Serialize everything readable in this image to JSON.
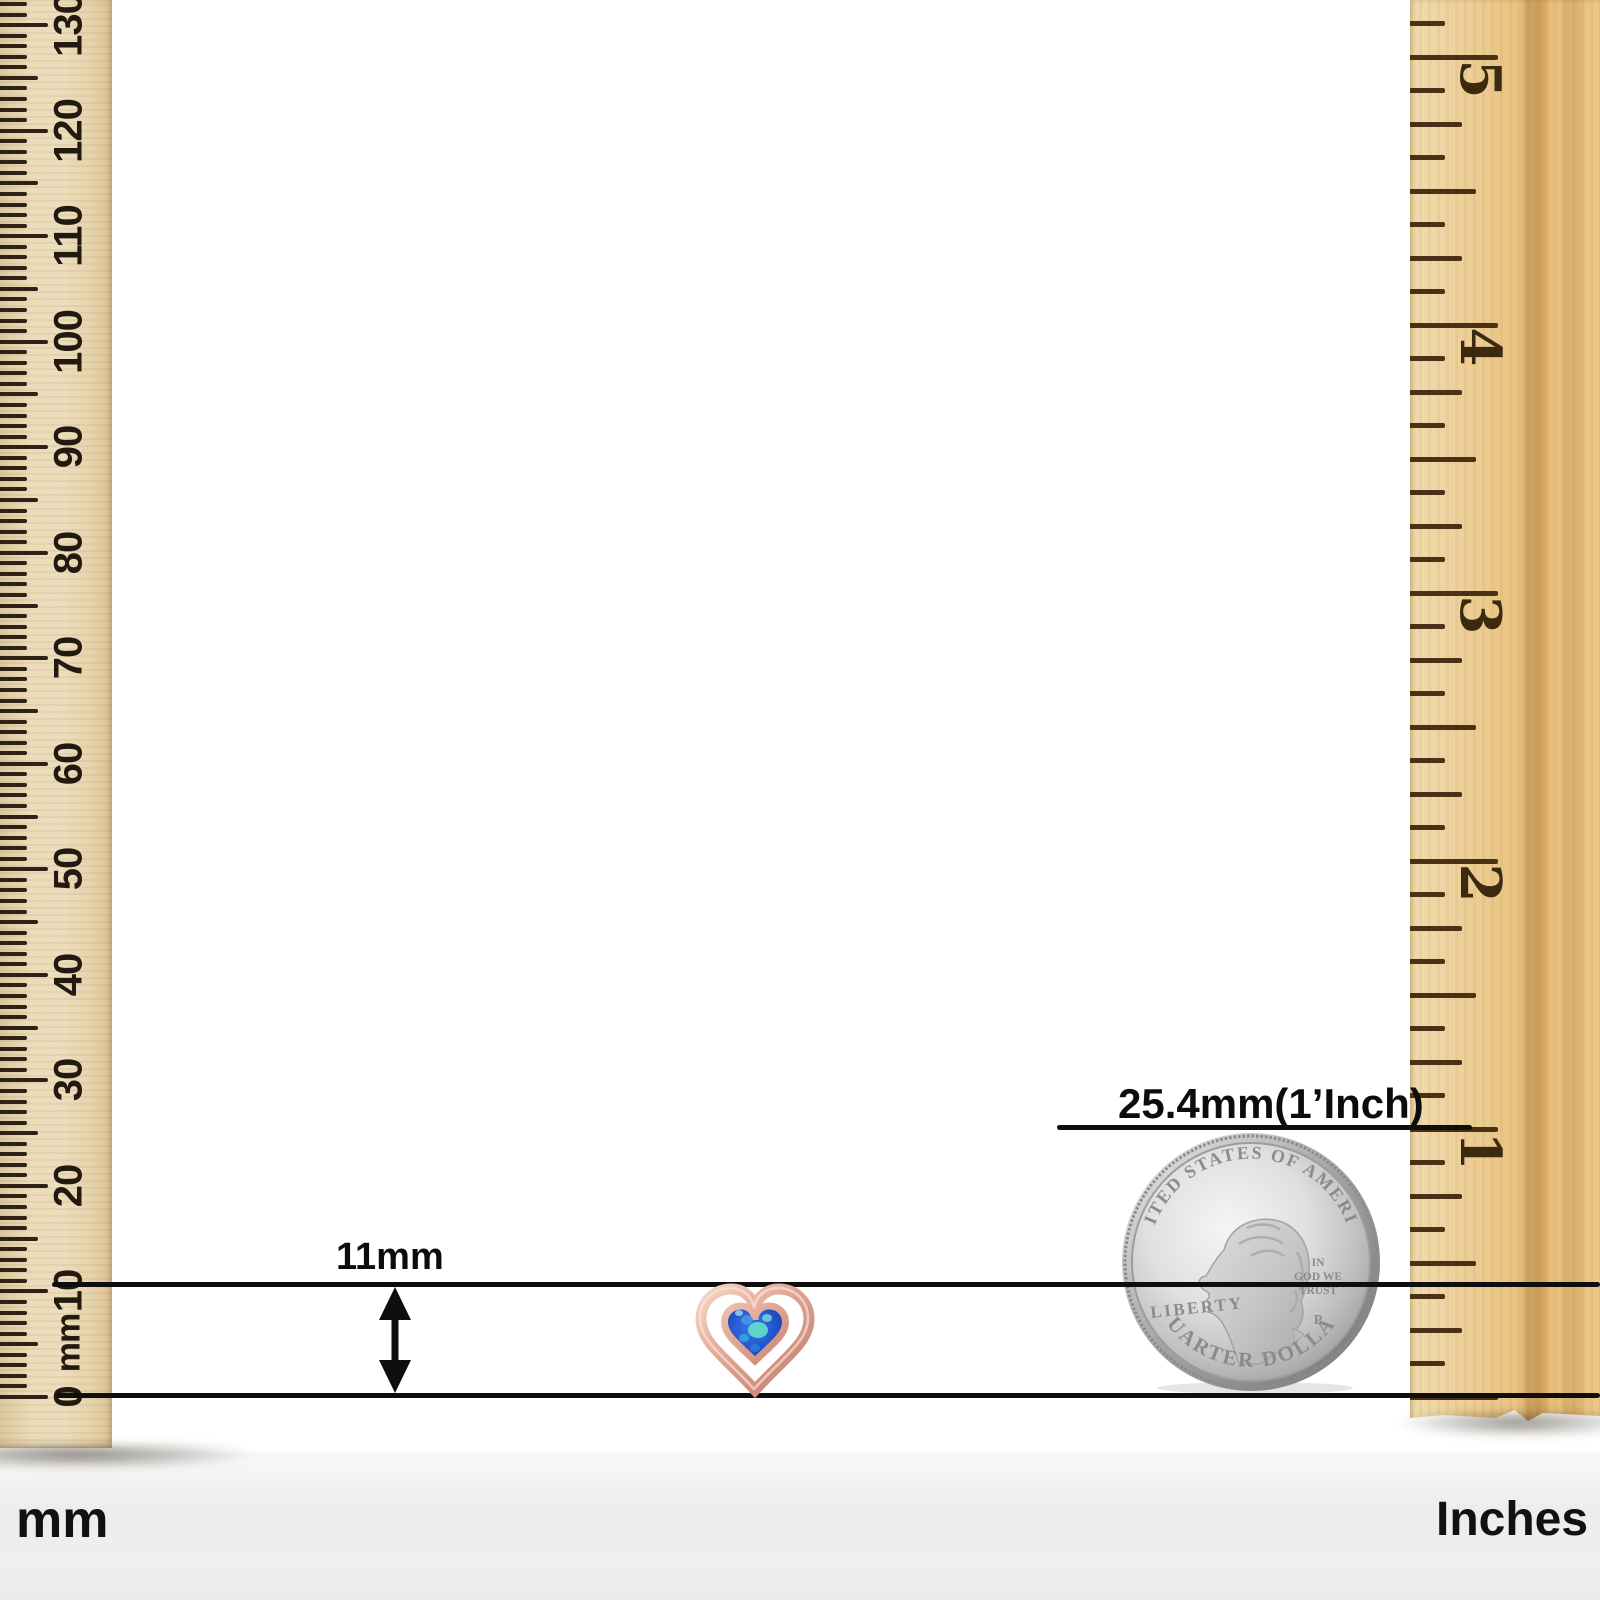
{
  "measurement": {
    "item_height_label": "11mm",
    "coin_reference_label": "25.4mm(1’Inch)"
  },
  "footer": {
    "left_unit": "mm",
    "right_unit": "Inches"
  },
  "left_ruler": {
    "zero_label": "0",
    "unit_label": "mm",
    "tick_labels": [
      "10",
      "20",
      "30",
      "40",
      "50",
      "60",
      "70",
      "80",
      "90",
      "100",
      "110",
      "120",
      "130"
    ]
  },
  "right_ruler": {
    "tick_labels": [
      "1",
      "2",
      "3",
      "4",
      "5"
    ]
  },
  "coin": {
    "top_legend": "UNITED STATES OF AMERICA",
    "left_legend": "LIBERTY",
    "motto_lines": [
      "IN",
      "GOD WE",
      "TRUST"
    ],
    "mint_mark": "P",
    "bottom_legend": "QUARTER DOLLAR"
  },
  "item": {
    "kind": "rose-gold open heart stud with heart-shaped blue opal",
    "colors": {
      "rose_gold_light": "#f3cdbd",
      "rose_gold_mid": "#dfa08f",
      "rose_gold_dark": "#c27f6f",
      "opal_deep_blue": "#1f45c0",
      "opal_blue": "#2a63d8",
      "opal_aqua": "#63e0c8"
    }
  },
  "icons": {
    "height_arrow": "double-headed-vertical-arrow"
  }
}
